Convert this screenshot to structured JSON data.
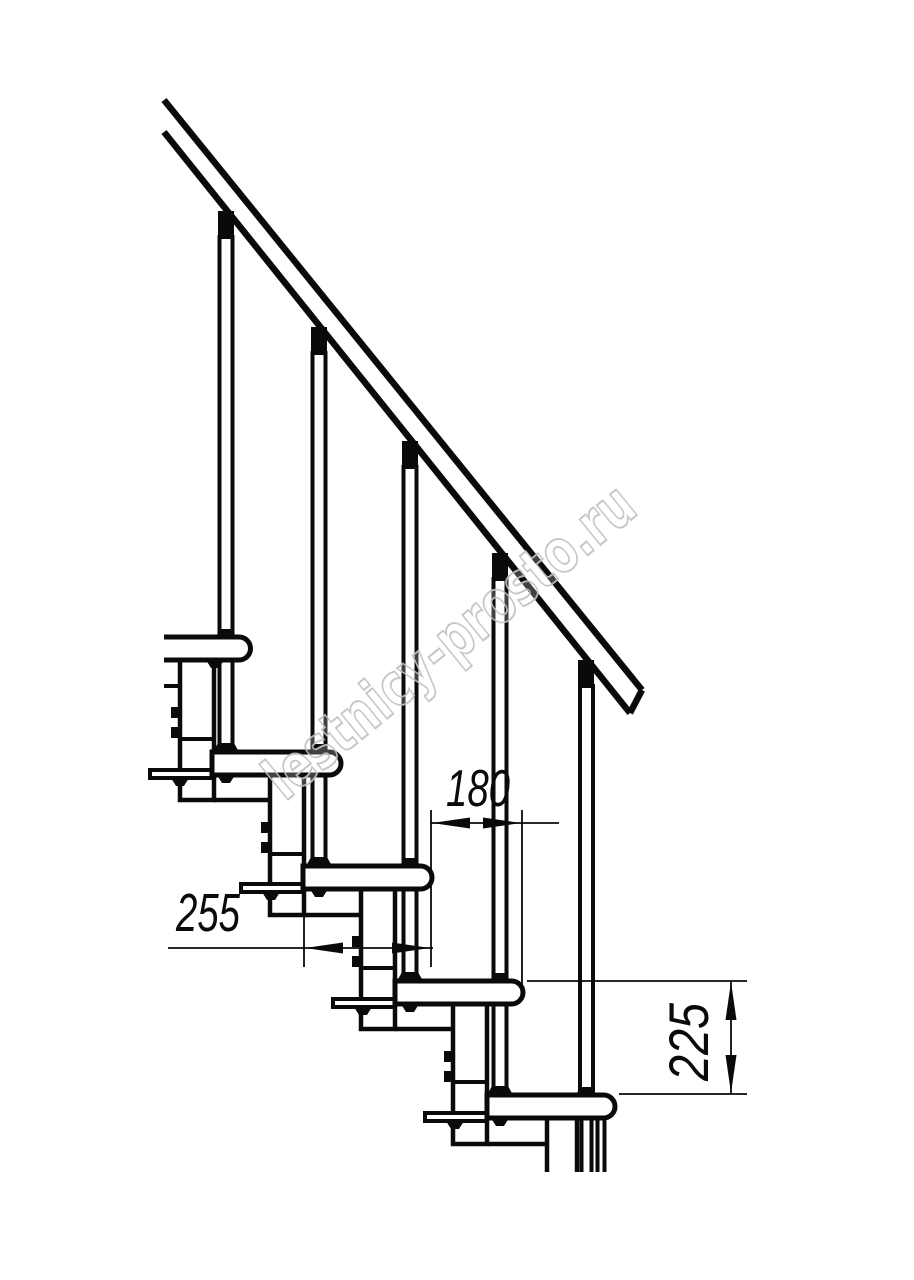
{
  "drawing": {
    "type": "modular-staircase-side-elevation",
    "background_color": "#ffffff",
    "line_color": "#0a0a0a",
    "watermark": {
      "text": "lestnicy-prosto.ru",
      "color": "#c2c2c2"
    },
    "dimensions": {
      "step_run": {
        "label": "180",
        "orientation": "horizontal"
      },
      "tread_depth": {
        "label": "255",
        "orientation": "horizontal"
      },
      "step_rise": {
        "label": "225",
        "orientation": "vertical"
      }
    },
    "counts": {
      "treads_visible": "5",
      "balusters_visible": "5"
    }
  }
}
